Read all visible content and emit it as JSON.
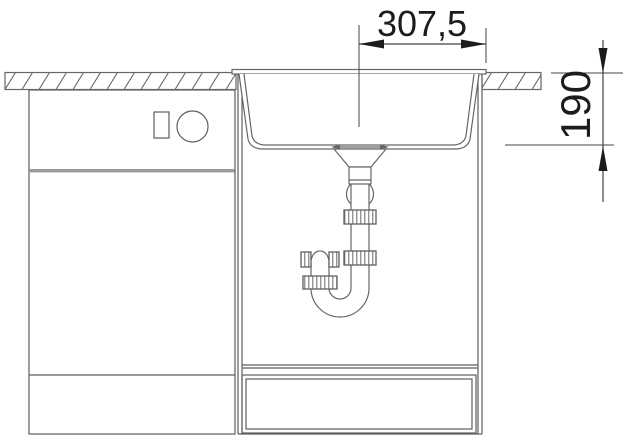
{
  "drawing": {
    "dimension_labels": {
      "half_width": "307,5",
      "bowl_depth": "190"
    }
  },
  "colors": {
    "background": "#ffffff",
    "drawing_line": "#666666",
    "cabinet_line": "#5e5e5e",
    "divider_gray": "#9c9c9c",
    "dimension_line": "#444444",
    "dimension_arrow": "#1c1c1c",
    "dimension_text": "#1c1c1c"
  }
}
